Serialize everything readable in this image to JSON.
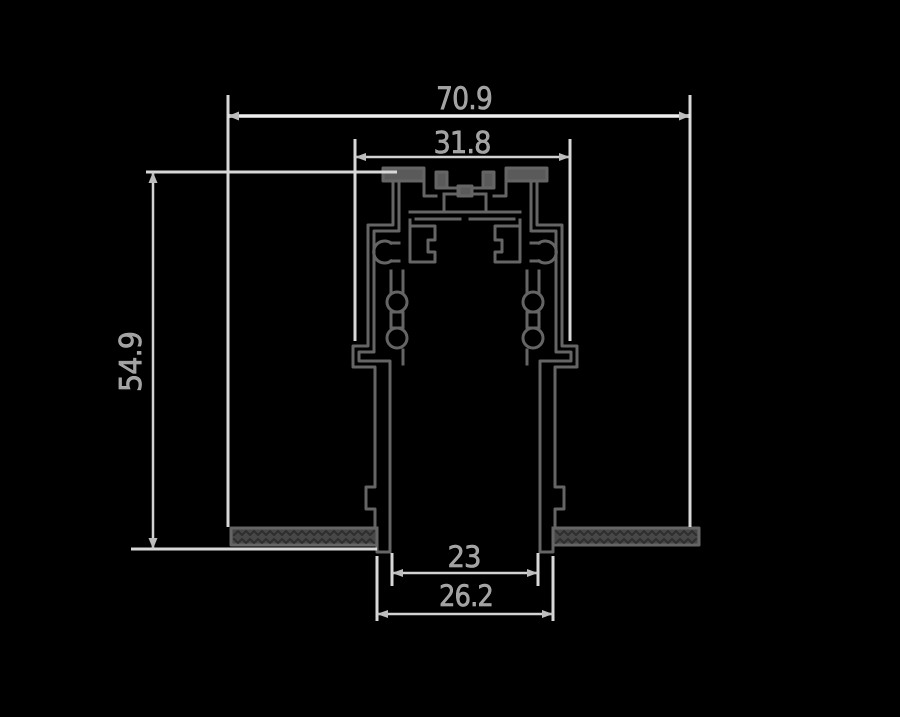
{
  "drawing": {
    "type": "technical-cross-section-profile",
    "colors": {
      "background": "#000000",
      "dimension_line": "#d2d2d2",
      "dimension_line_bright": "#efefef",
      "extension_line": "#d8d8d8",
      "arrow": "#bdbdbd",
      "label": "#a3a3a3",
      "profile": "#656565",
      "profile_fill": "#5a5a5a",
      "flange_fill": "#474747",
      "texture": "#2e2e2e"
    },
    "dimensions": {
      "overall_width": {
        "value": "70.9"
      },
      "top_width": {
        "value": "31.8"
      },
      "height": {
        "value": "54.9"
      },
      "inner_opening": {
        "value": "23"
      },
      "outer_opening": {
        "value": "26.2"
      }
    }
  }
}
